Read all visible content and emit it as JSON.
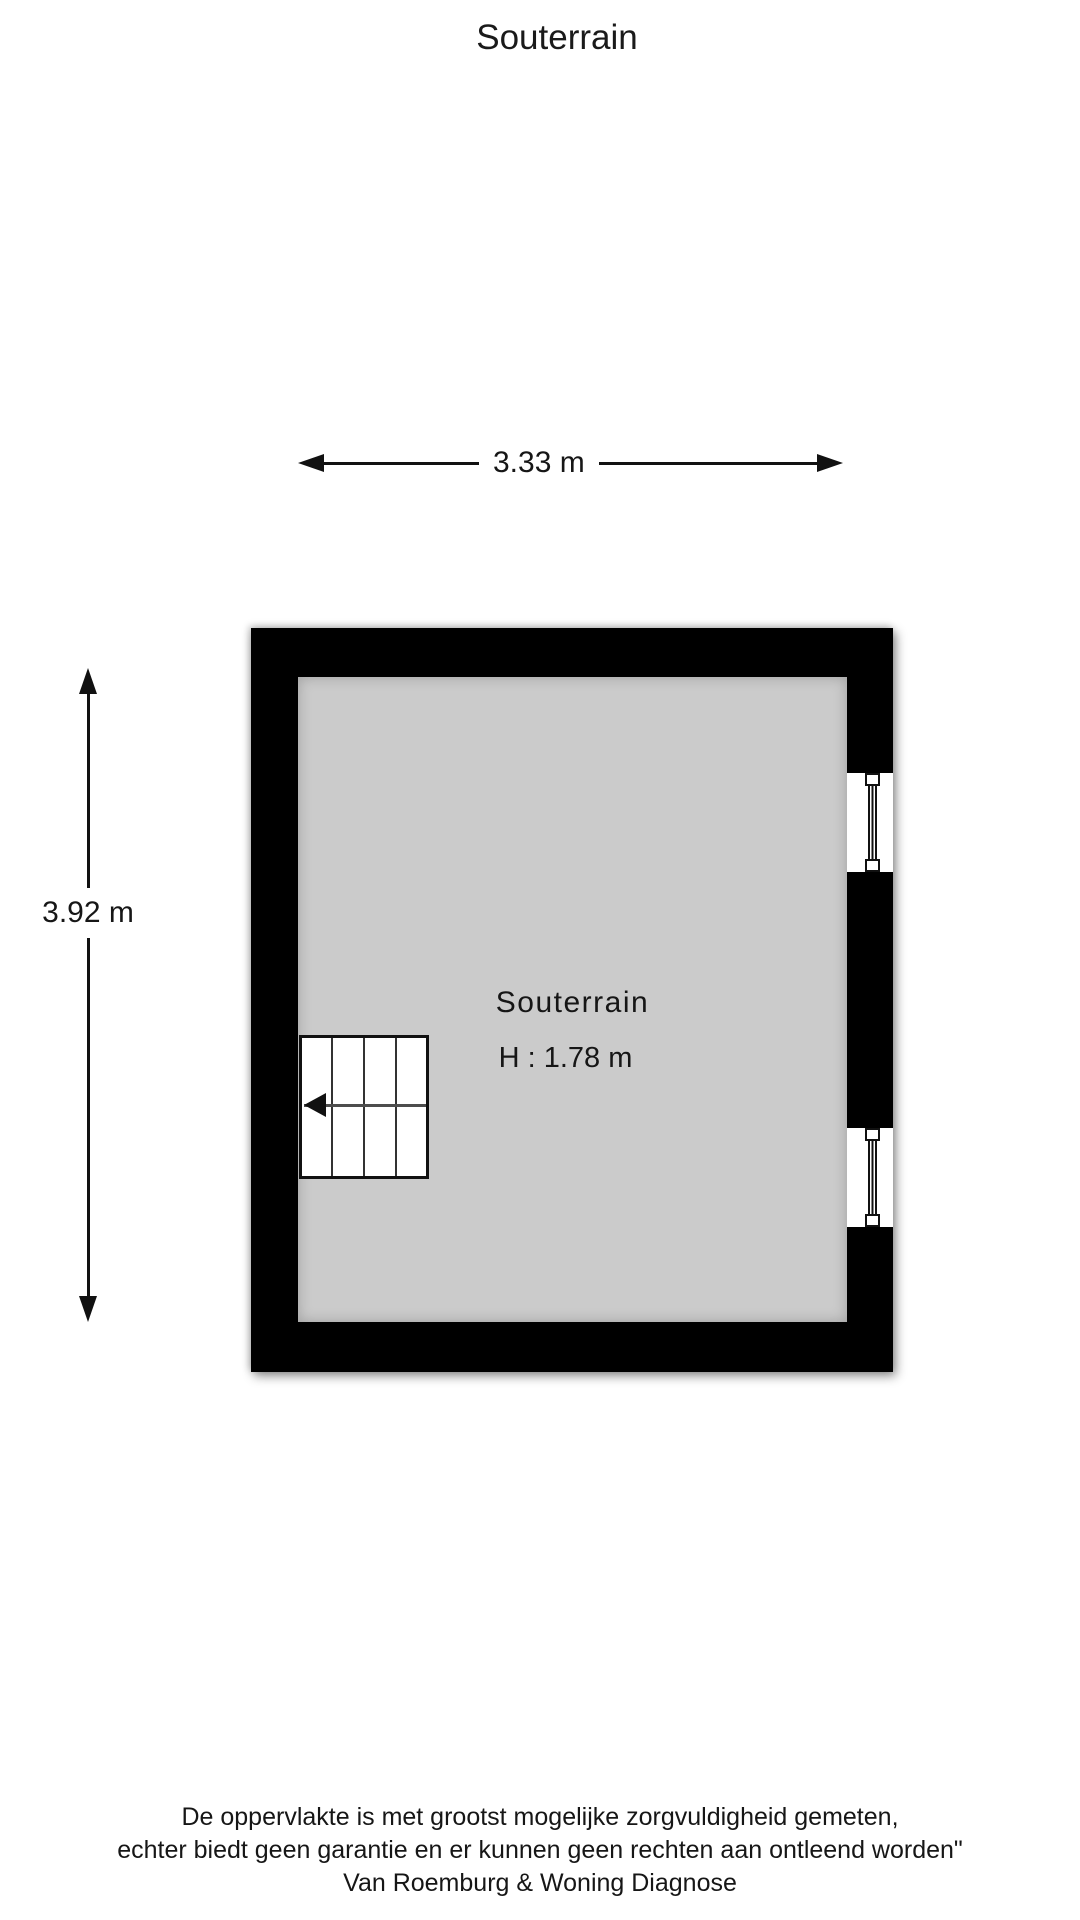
{
  "header": {
    "title": "Souterrain"
  },
  "dimensions": {
    "width": {
      "label": "3.33 m"
    },
    "height": {
      "label": "3.92 m"
    }
  },
  "room": {
    "name": "Souterrain",
    "ceiling_height": "H : 1.78 m"
  },
  "colors": {
    "wall": "#000000",
    "floor": "#cbcbcb",
    "ink": "#111111",
    "stair_direction_line": "#4d4d4d"
  },
  "footer": {
    "line1": "De oppervlakte is met grootst mogelijke zorgvuldigheid gemeten,",
    "line2": "echter biedt geen garantie en er kunnen geen rechten aan ontleend worden\"",
    "line3": "Van Roemburg & Woning Diagnose"
  }
}
